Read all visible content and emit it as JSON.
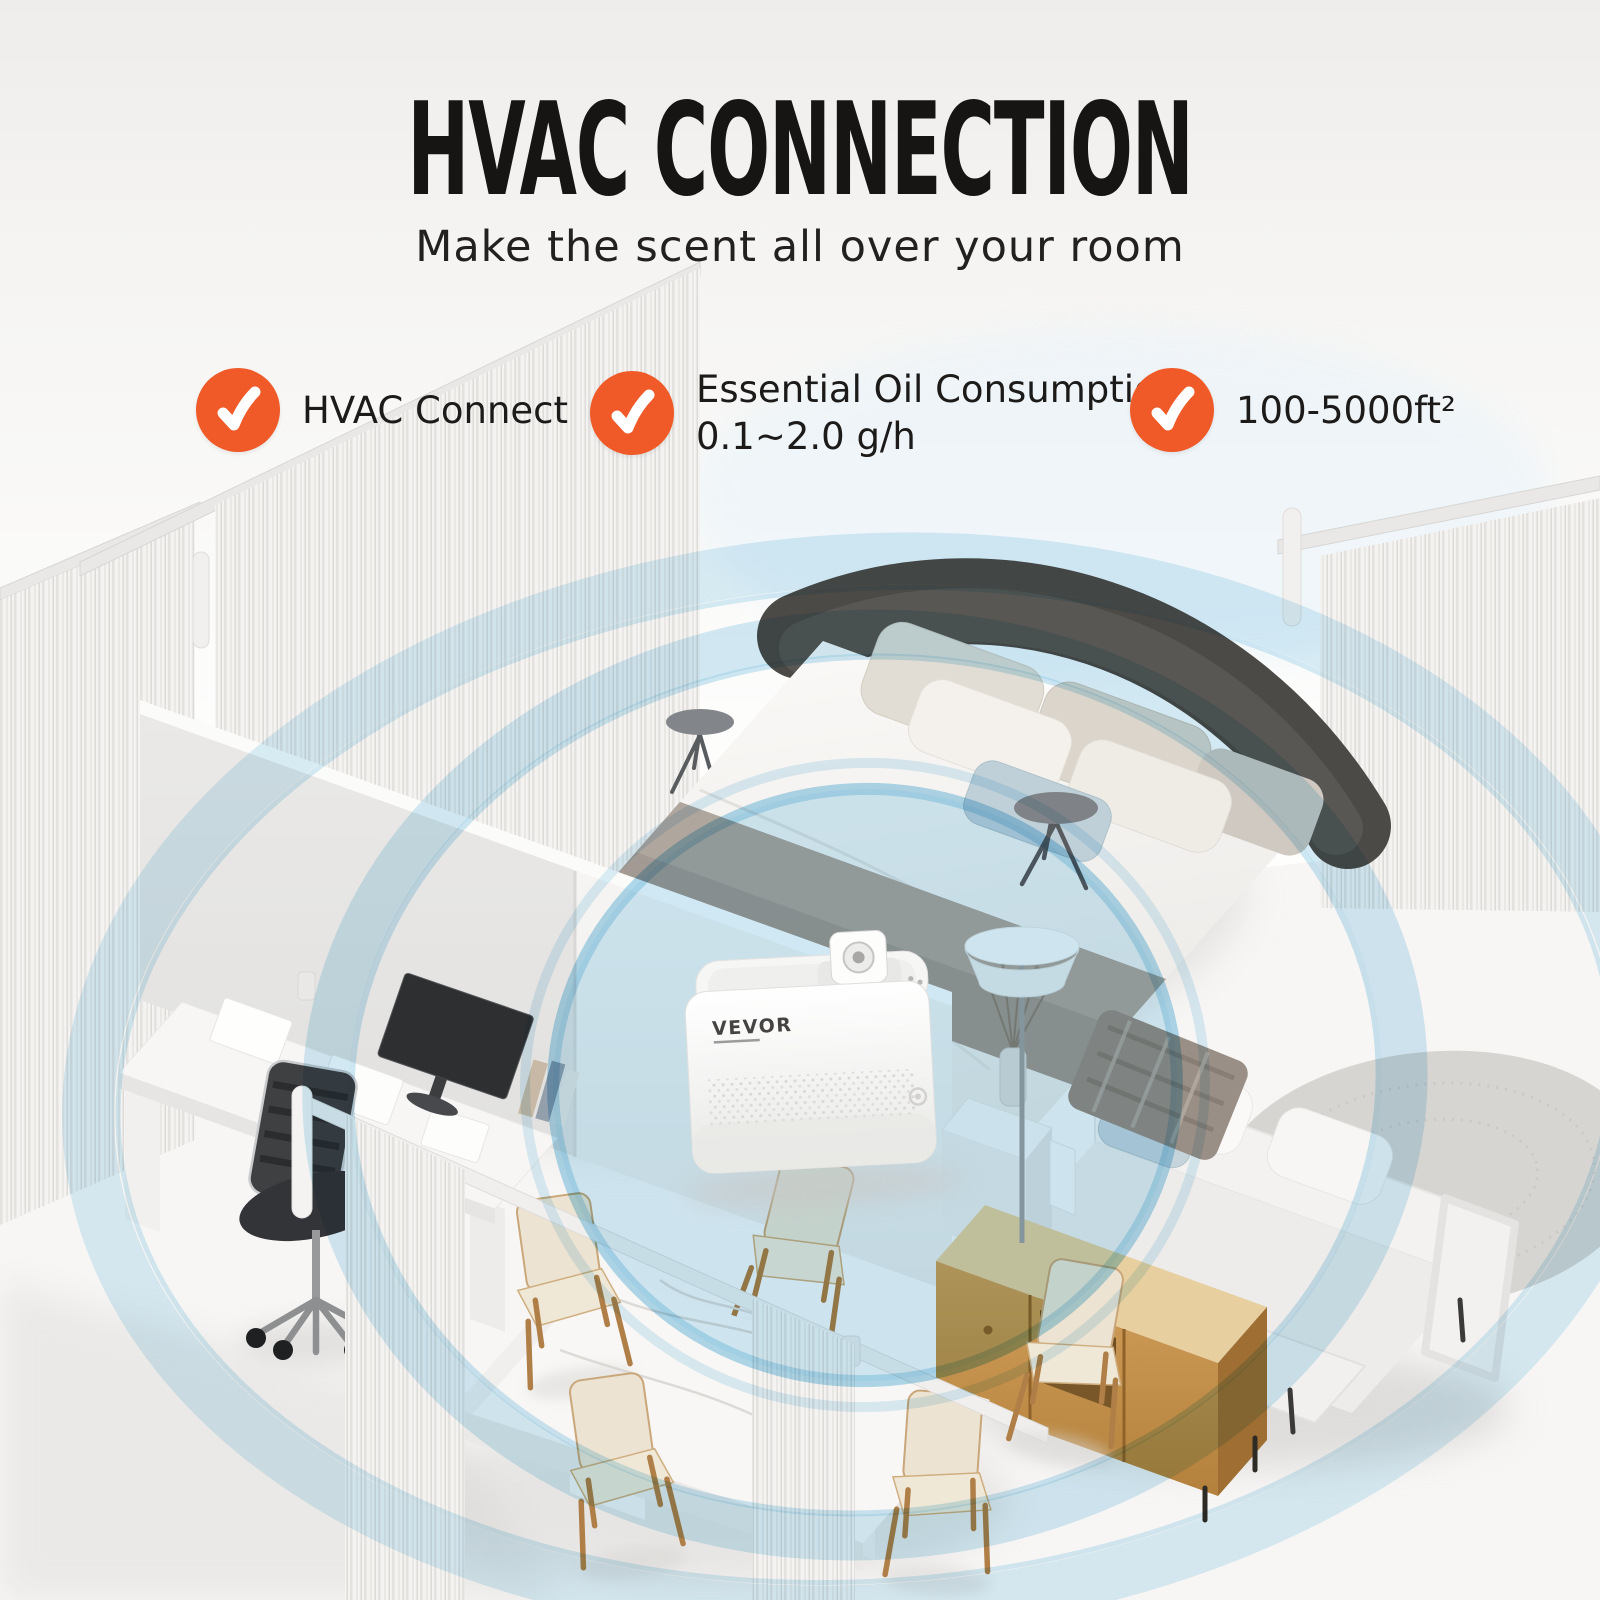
{
  "header": {
    "title": "HVAC CONNECTION",
    "subtitle": "Make the scent all over your room"
  },
  "features": [
    {
      "icon": "check-icon",
      "lines": [
        "HVAC Connect",
        ""
      ]
    },
    {
      "icon": "check-icon",
      "lines": [
        "Essential Oil Consumption",
        "0.1~2.0 g/h"
      ]
    },
    {
      "icon": "check-icon",
      "lines": [
        "100-5000ft²",
        ""
      ]
    }
  ],
  "device": {
    "brand": "VEVOR"
  },
  "colors": {
    "accent_orange": "#F05A28",
    "check_white": "#FFFFFF",
    "ring_blue": "#A9D8EE",
    "title_color": "#171513",
    "wood": "#C69453"
  }
}
